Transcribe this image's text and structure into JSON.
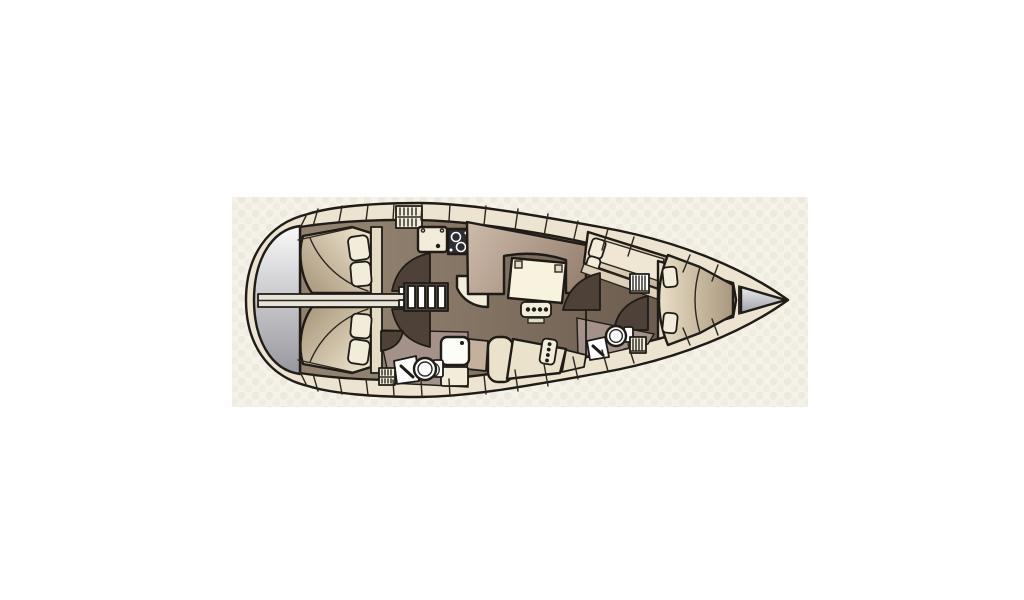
{
  "window": {
    "width": 1024,
    "height": 600,
    "background": "#ffffff"
  },
  "plan": {
    "title": "Sailing yacht interior layout — top view floor plan",
    "frame": {
      "x": 232,
      "y": 197,
      "width": 576,
      "height": 210
    },
    "palette": {
      "outline": "#1f1b16",
      "deck_line": "#2b261f",
      "photo_bg": "#f5f2e9",
      "photo_texture": "#e7e2d2",
      "photo_texture2": "#ede9db",
      "hull": "#ece4d1",
      "floor_a": "#91816f",
      "floor_b": "#5f5145",
      "platform_a": "#fafafa",
      "platform_b": "#94949b",
      "berth_a": "#ebe1c9",
      "berth_b": "#a6957a",
      "settee_a": "#cdb9a9",
      "settee_b": "#917b6a",
      "table": "#f8f3df",
      "counter": "#f2ecdb",
      "fixture": "#ffffff",
      "stove": "#2e2e32",
      "door": "#4e4138",
      "head_floor": "#a3918a",
      "cream_seat": "#ebe2cc",
      "tan_block": "#c4b09c",
      "shelf": "#e4dbc4",
      "cabin_base": "#e9e0ca",
      "anchor_a": "#f4f4f4",
      "anchor_b": "#9598a1",
      "pillow": "#f2ecdb",
      "bar": "#e9e4d8",
      "divider_bar": "#e9e4d8"
    },
    "areas": [
      {
        "id": "swim-platform"
      },
      {
        "id": "aft-cabin-port"
      },
      {
        "id": "aft-cabin-starboard"
      },
      {
        "id": "engine-trunk"
      },
      {
        "id": "companionway-ladder"
      },
      {
        "id": "galley"
      },
      {
        "id": "saloon"
      },
      {
        "id": "aft-head"
      },
      {
        "id": "forward-head"
      },
      {
        "id": "forward-port-berth"
      },
      {
        "id": "owner-v-berth"
      },
      {
        "id": "anchor-locker"
      },
      {
        "id": "side-decks"
      }
    ]
  }
}
